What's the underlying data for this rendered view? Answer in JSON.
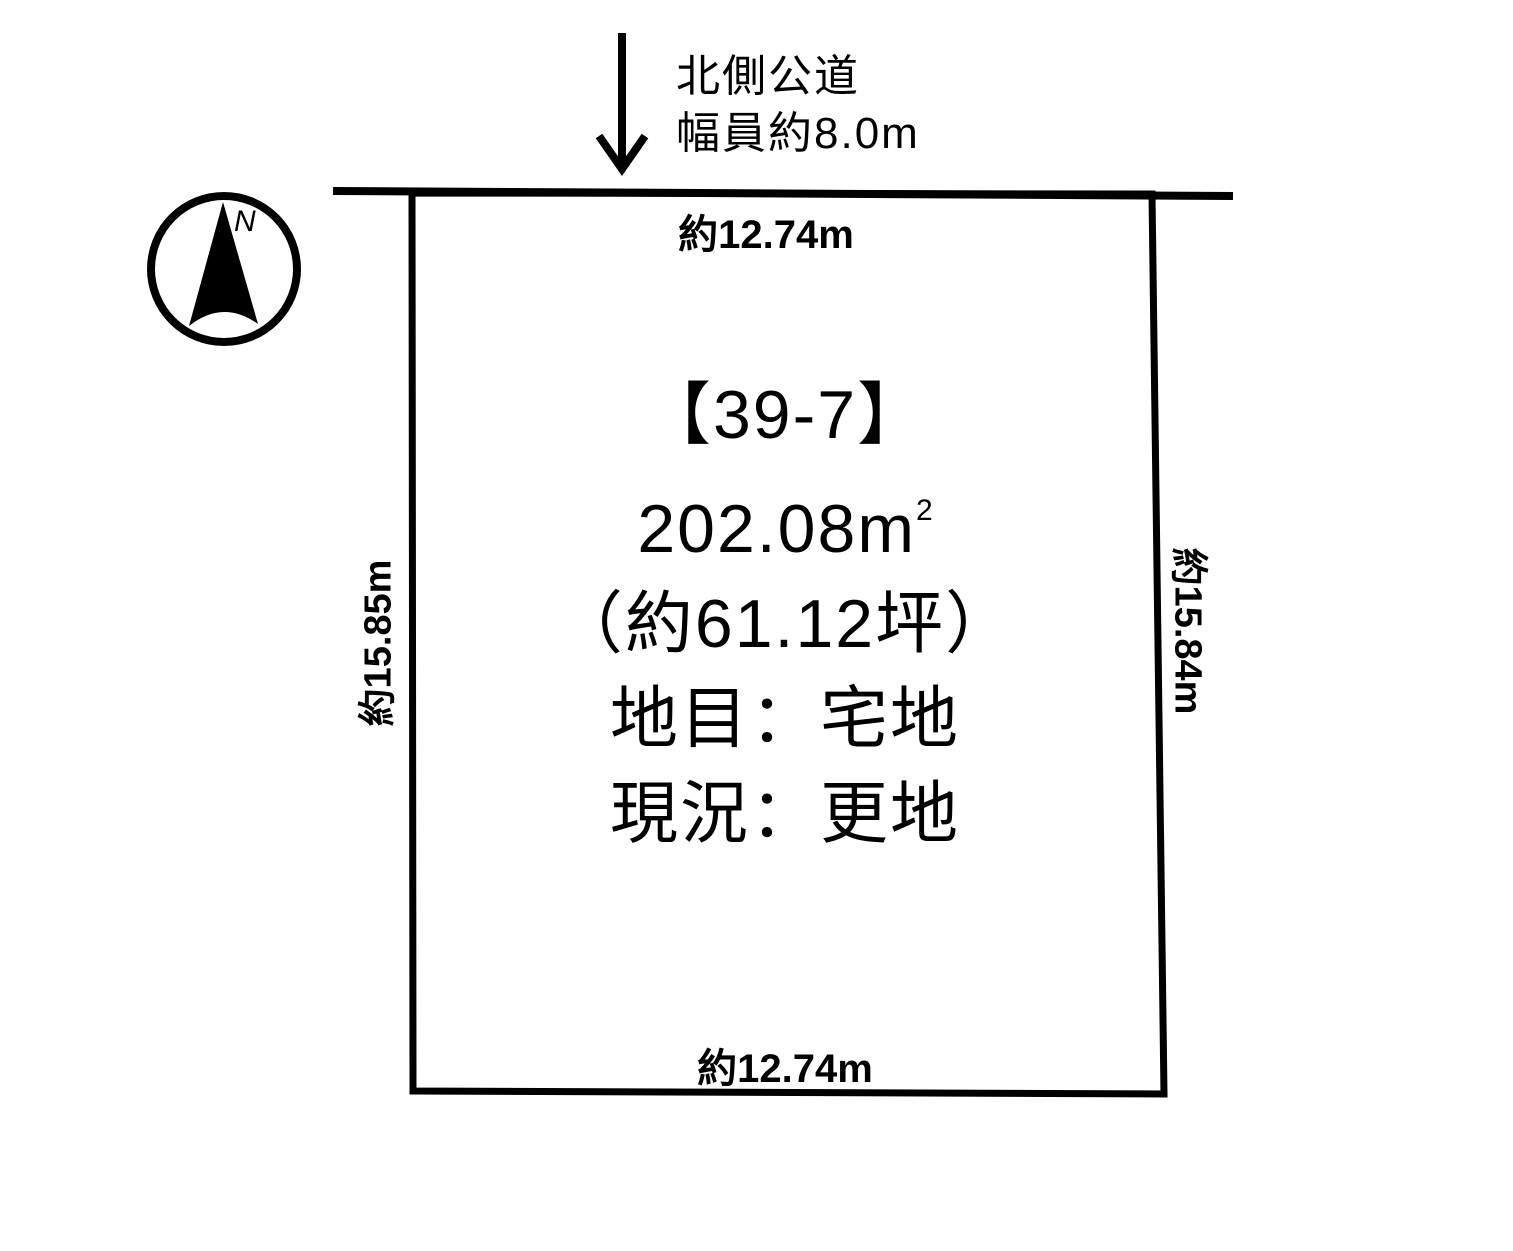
{
  "colors": {
    "ink": "#000000",
    "background": "#ffffff"
  },
  "compass": {
    "north_label": "N"
  },
  "road": {
    "label_line1": "北側公道",
    "label_line2": "幅員約8.0m"
  },
  "dimensions": {
    "top": "約12.74m",
    "bottom": "約12.74m",
    "left": "約15.85m",
    "right": "約15.84m"
  },
  "plot": {
    "lot_number": "【39-7】",
    "area_m2": "202.08m",
    "area_m2_sup": "2",
    "area_tsubo": "（約61.12坪）",
    "land_category": "地目：宅地",
    "current_status": "現況：更地"
  }
}
